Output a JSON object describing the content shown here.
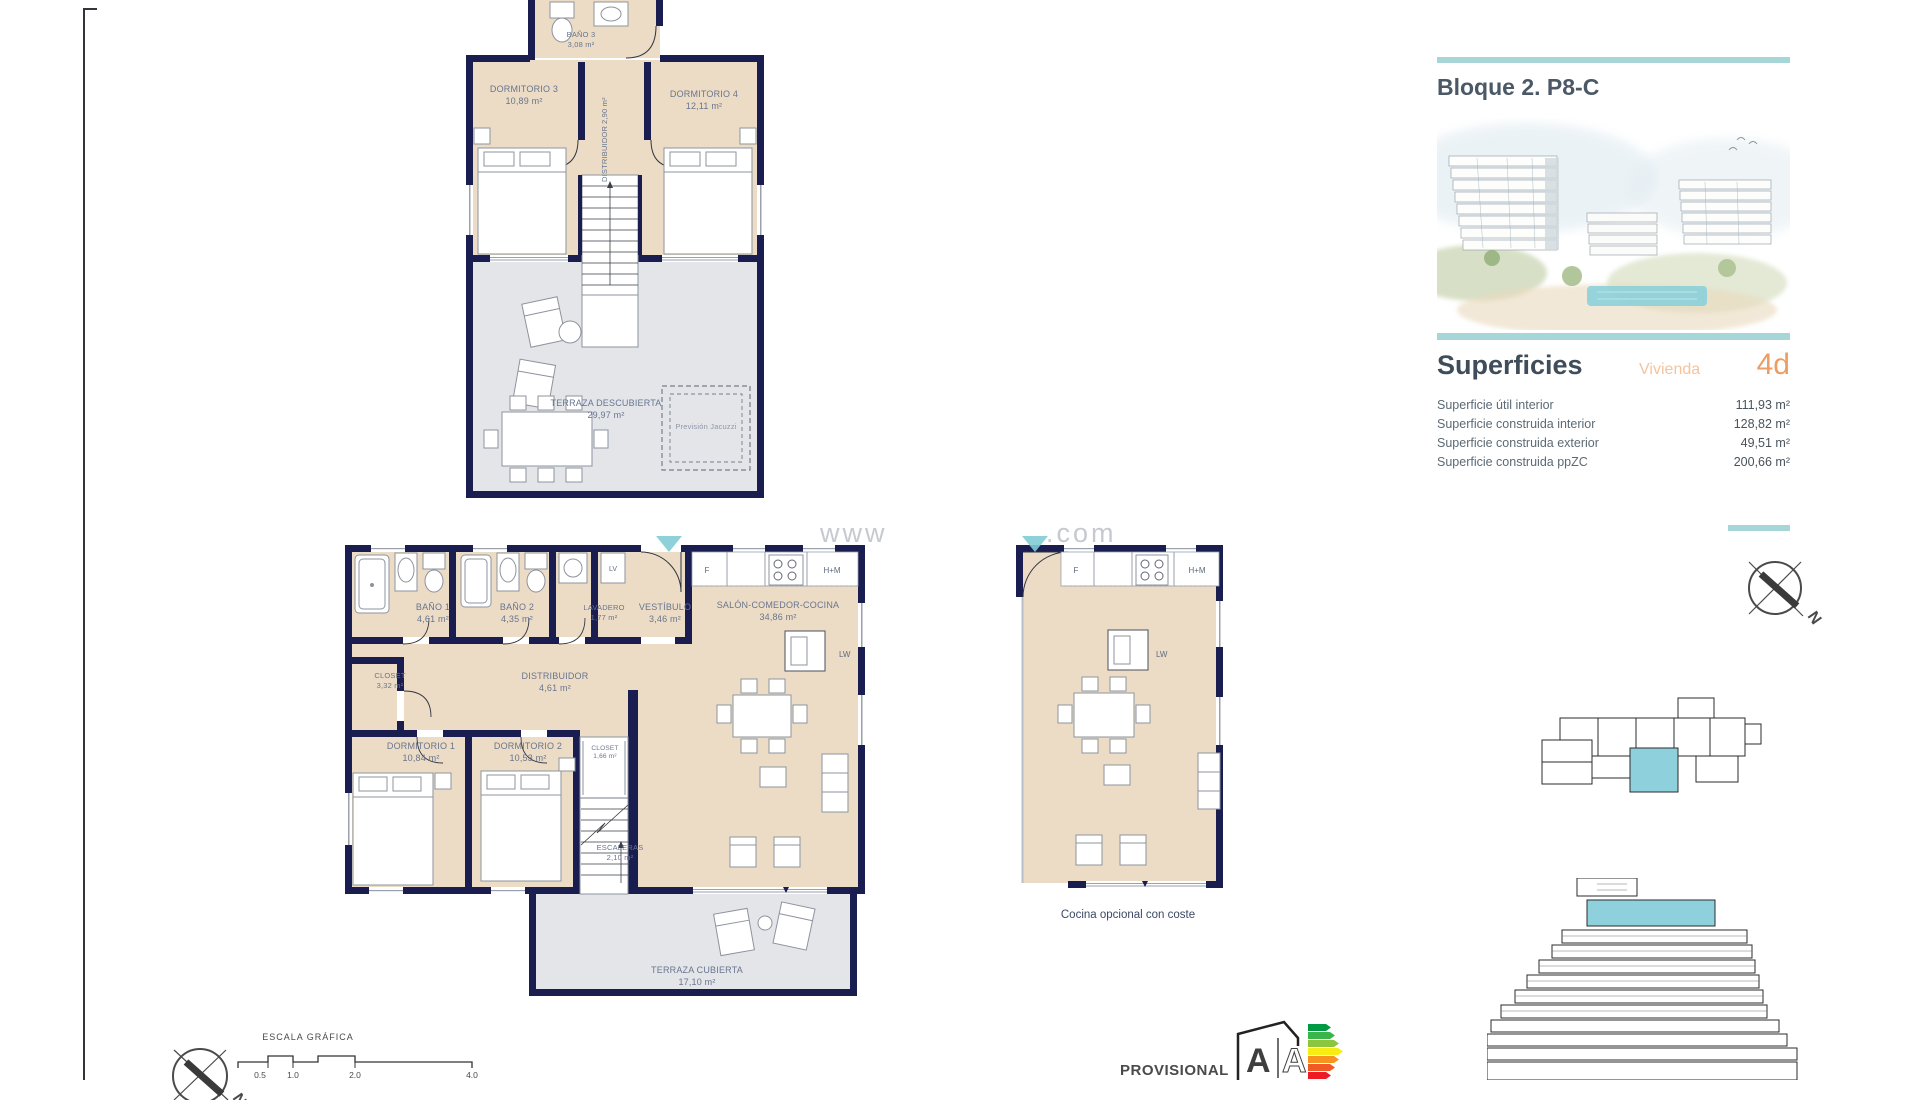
{
  "right_panel": {
    "block_title": "Bloque 2. P8-C",
    "superficies_title": "Superficies",
    "vivienda_label": "Vivienda",
    "vivienda_code": "4d",
    "surface_rows": [
      {
        "label": "Superficie útil interior",
        "value": "111,93 m²"
      },
      {
        "label": "Superficie construida interior",
        "value": "128,82 m²"
      },
      {
        "label": "Superficie construida exterior",
        "value": "49,51 m²"
      },
      {
        "label": "Superficie construida ppZC",
        "value": "200,66 m²"
      }
    ],
    "compass_n": "N"
  },
  "plans": {
    "upper": {
      "rooms": [
        {
          "name": "BAÑO 3",
          "area": "3,08 m²"
        },
        {
          "name": "DORMITORIO 3",
          "area": "10,89 m²"
        },
        {
          "name": "DISTRIBUIDOR",
          "area": "2,90 m²"
        },
        {
          "name": "DORMITORIO 4",
          "area": "12,11 m²"
        },
        {
          "name": "TERRAZA DESCUBIERTA",
          "area": "29,97 m²"
        },
        {
          "name": "Previsión Jacuzzi",
          "area": ""
        }
      ]
    },
    "lower": {
      "rooms": [
        {
          "name": "BAÑO 1",
          "area": "4,61 m²"
        },
        {
          "name": "BAÑO 2",
          "area": "4,35 m²"
        },
        {
          "name": "LAVADERO",
          "area": "1,77 m²"
        },
        {
          "name": "VESTÍBULO",
          "area": "3,46 m²"
        },
        {
          "name": "SALÓN-COMEDOR-COCINA",
          "area": "34,86 m²"
        },
        {
          "name": "CLOSET",
          "area": "3,32 m²"
        },
        {
          "name": "DISTRIBUIDOR",
          "area": "4,61 m²"
        },
        {
          "name": "DORMITORIO 1",
          "area": "10,84 m²"
        },
        {
          "name": "DORMITORIO 2",
          "area": "10,53 m²"
        },
        {
          "name": "CLOSET",
          "area": "1,66 m²"
        },
        {
          "name": "ESCALERAS",
          "area": "2,10 m²"
        },
        {
          "name": "TERRAZA CUBIERTA",
          "area": "17,10 m²"
        }
      ],
      "appliances": {
        "fridge": "F",
        "oven": "H+M",
        "lv": "LV",
        "lw": "LW"
      }
    },
    "optional": {
      "caption": "Cocina opcional con coste",
      "appliances": {
        "fridge": "F",
        "oven": "H+M",
        "lw": "LW"
      }
    }
  },
  "scale_bar": {
    "title": "ESCALA GRÁFICA",
    "ticks": [
      "0.5",
      "1.0",
      "2.0",
      "4.0"
    ]
  },
  "footer": {
    "provisional": "PROVISIONAL",
    "energy_letter_left": "A",
    "energy_letter_right": "A",
    "compass_n": "N"
  },
  "watermark": {
    "left": "www",
    "right": ".com"
  },
  "colors": {
    "teal_rule": "#a6d6d8",
    "teal_fill": "#8ed0dc",
    "orange": "#ed9c64",
    "peach": "#f4c49d",
    "navy": "#1a1d50",
    "beige": "#ecdcc6",
    "terrace_gray": "#e4e5e9",
    "heading": "#4b5966",
    "label_blue": "#67758f"
  }
}
